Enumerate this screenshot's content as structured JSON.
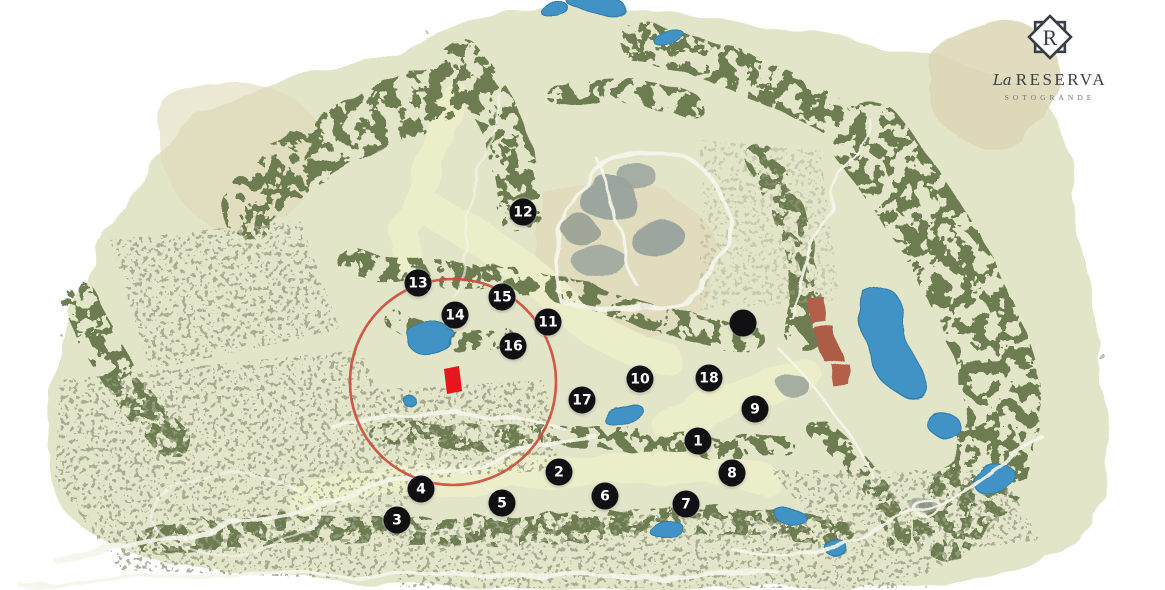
{
  "logo": {
    "monogram": "R",
    "prefix": "La",
    "name": "RESERVA",
    "subtitle": "SOTOGRANDE"
  },
  "colors": {
    "highlight_circle": "#cd4a39",
    "selected_plot": "#e7161d",
    "marker_bg": "#111114",
    "marker_text": "#ffffff",
    "lake_blue": "#3f93c4",
    "logo_ink": "#383e44"
  },
  "highlight": {
    "circle_cx": "453",
    "circle_cy": "382",
    "circle_r": "103",
    "plot_points": "444,369 459,366 462,391 447,394"
  },
  "markers": [
    {
      "label": "1",
      "style": "left:698px;top:441px"
    },
    {
      "label": "2",
      "style": "left:559px;top:472px"
    },
    {
      "label": "3",
      "style": "left:397px;top:520px"
    },
    {
      "label": "4",
      "style": "left:421px;top:489px"
    },
    {
      "label": "5",
      "style": "left:502px;top:503px"
    },
    {
      "label": "6",
      "style": "left:605px;top:496px"
    },
    {
      "label": "7",
      "style": "left:686px;top:504px"
    },
    {
      "label": "8",
      "style": "left:732px;top:473px"
    },
    {
      "label": "9",
      "style": "left:755px;top:409px"
    },
    {
      "label": "10",
      "style": "left:640px;top:379px"
    },
    {
      "label": "11",
      "style": "left:548px;top:322px"
    },
    {
      "label": "12",
      "style": "left:523px;top:212px"
    },
    {
      "label": "13",
      "style": "left:418px;top:283px"
    },
    {
      "label": "14",
      "style": "left:455px;top:315px"
    },
    {
      "label": "15",
      "style": "left:502px;top:297px"
    },
    {
      "label": "16",
      "style": "left:513px;top:346px"
    },
    {
      "label": "17",
      "style": "left:582px;top:400px"
    },
    {
      "label": "18",
      "style": "left:709px;top:378px"
    },
    {
      "label": "",
      "style": "left:743px;top:323px"
    }
  ]
}
